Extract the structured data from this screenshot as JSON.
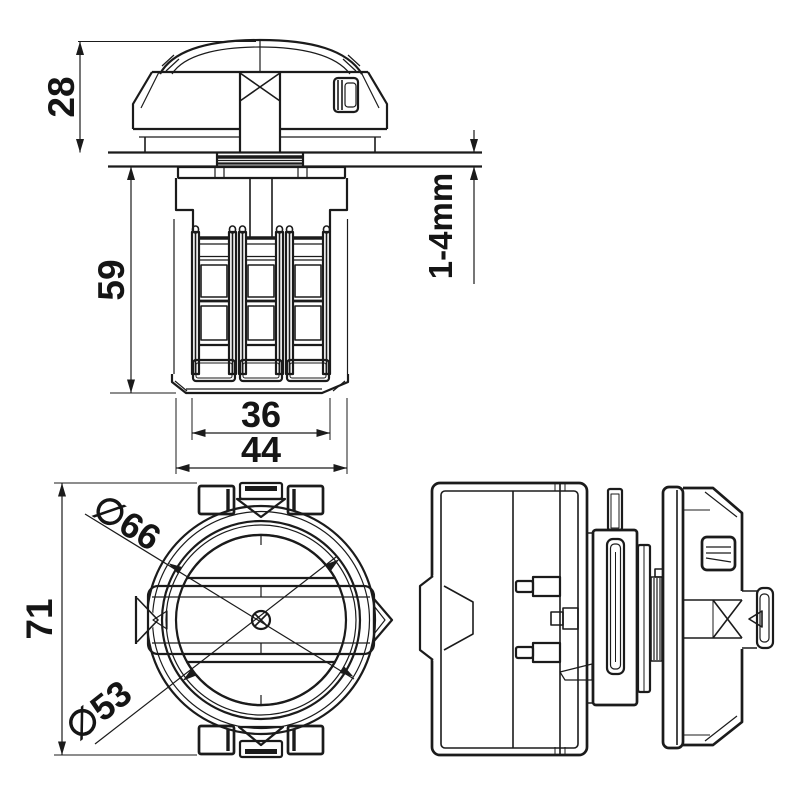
{
  "drawing": {
    "type": "technical-dimension-drawing",
    "dims": {
      "knob_height": "28",
      "body_height": "59",
      "claw_width": "36",
      "housing_width": "44",
      "clamp_range": "1-4mm",
      "outer_dia": "∅66",
      "inner_dia": "∅53",
      "overall_height": "71"
    },
    "colors": {
      "line": "#1b1b1b",
      "background": "#ffffff"
    }
  }
}
